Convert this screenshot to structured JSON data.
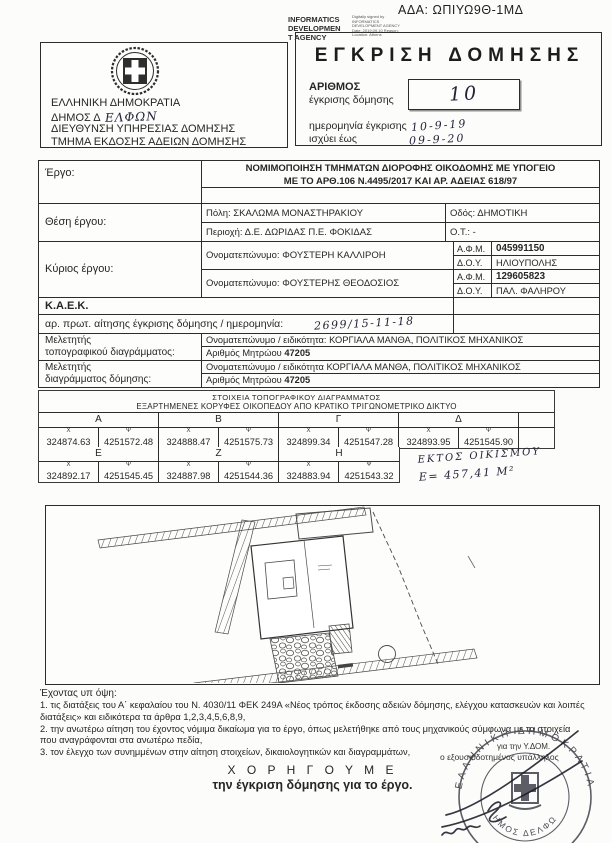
{
  "page": {
    "ada": "ΑΔΑ: ΩΠΙΥΩ9Θ-1ΜΔ",
    "title": "ΕΓΚΡΙΣΗ ΔΟΜΗΣΗΣ"
  },
  "digital_stamp": {
    "agency_line1": "INFORMATICS",
    "agency_line2": "DEVELOPMEN",
    "agency_line3": "T AGENCY",
    "detail_lines": "Digitally signed by INFORMATICS DEVELOPMENT AGENCY Date: 2019.09.10 Reason: Location: Athens"
  },
  "issuer": {
    "line1": "ΕΛΛΗΝΙΚΗ ΔΗΜΟΚΡΑΤΙΑ",
    "line2_printed": "ΔΗΜΟΣ Δ",
    "line2_hand": "ΕΛΦΩΝ",
    "line3": "ΔΙΕΥΘΥΝΣΗ ΥΠΗΡΕΣΙΑΣ ΔΟΜΗΣΗΣ",
    "line4": "ΤΜΗΜΑ ΕΚΔΟΣΗΣ ΑΔΕΙΩΝ ΔΟΜΗΣΗΣ"
  },
  "approval": {
    "number_label1": "ΑΡΙΘΜΟΣ",
    "number_label2": "έγκρισης δόμησης",
    "number_value": "10",
    "date_label": "ημερομηνία έγκρισης",
    "date_value": "10-9-19",
    "valid_label": "ισχύει έως",
    "valid_value": "09-9-20"
  },
  "project": {
    "label": "Έργο:",
    "line1": "ΝΟΜΙΜΟΠΟΙΗΣΗ ΤΜΗΜΑΤΩΝ ΔΙΟΡΟΦΗΣ ΟΙΚΟΔΟΜΗΣ ΜΕ ΥΠΟΓΕΙΟ",
    "line2": "ΜΕ ΤΟ ΑΡΘ.106 Ν.4495/2017 ΚΑΙ ΑΡ. ΑΔΕΙΑΣ 618/97"
  },
  "location": {
    "label": "Θέση έργου:",
    "city": "Πόλη: ΣΚΑΛΩΜΑ ΜΟΝΑΣΤΗΡΑΚΙΟΥ",
    "street": "Οδός: ΔΗΜΟΤΙΚΗ",
    "area": "Περιοχή: Δ.Ε. ΔΩΡΙΔΑΣ Π.Ε. ΦΟΚΙΔΑΣ",
    "ot": "Ο.Τ.: -"
  },
  "owner": {
    "label": "Κύριος  έργου:",
    "afm_label": "Α.Φ.Μ.",
    "doy_label": "Δ.Ο.Υ.",
    "entries": [
      {
        "name": "Ονοματεπώνυμο: ΦΟΥΣΤΕΡΗ ΚΑΛΛΙΡΟΗ",
        "afm": "045991150",
        "doy": "ΗΛΙΟΥΠΟΛΗΣ"
      },
      {
        "name": "Ονοματεπώνυμο: ΦΟΥΣΤΕΡΗΣ ΘΕΟΔΟΣΙΟΣ",
        "afm": "129605823",
        "doy": "ΠΑΛ. ΦΑΛΗΡΟΥ"
      }
    ]
  },
  "kaek": {
    "label": "Κ.Α.Ε.Κ."
  },
  "protocol": {
    "label": "αρ. πρωτ. αίτησης έγκρισης δόμησης / ημερομηνία:",
    "value": "2699/15-11-18"
  },
  "surveyor_topo": {
    "label_line1": "Μελετητής",
    "label_line2": "τοπογραφικού διαγράμματος:",
    "name_line": "Ονοματεπώνυμο / ειδικότητα: ΚΟΡΓΙΑΛΑ ΜΑΝΘΑ, ΠΟΛΙΤΙΚΟΣ ΜΗΧΑΝΙΚΟΣ",
    "reg_label": "Αριθμός Μητρώου",
    "reg_value": "47205"
  },
  "surveyor_diagram": {
    "label_line1": "Μελετητής",
    "label_line2": "διαγράμματος δόμησης:",
    "name_line": "Ονοματεπώνυμο / ειδικότητα ΚΟΡΓΙΑΛΑ ΜΑΝΘΑ, ΠΟΛΙΤΙΚΟΣ ΜΗΧΑΝΙΚΟΣ",
    "reg_label": "Αριθμός Μητρώου",
    "reg_value": "47205"
  },
  "coords": {
    "title1": "ΣΤΟΙΧΕΙΑ ΤΟΠΟΓΡΑΦΙΚΟΥ ΔΙΑΓΡΑΜΜΑΤΟΣ",
    "title2": "ΕΞΑΡΤΗΜΕΝΕΣ ΚΟΡΥΦΕΣ ΟΙΚΟΠΕΔΟΥ ΑΠΟ ΚΡΑΤΙΚΟ ΤΡΙΓΩΝΟΜΕΤΡΙΚΟ ΔΙΚΤΥΟ",
    "x_sym": "Χ",
    "y_sym": "Ψ",
    "points": [
      {
        "label": "Α",
        "x": "324874.63",
        "y": "4251572.48"
      },
      {
        "label": "Β",
        "x": "324888.47",
        "y": "4251575.73"
      },
      {
        "label": "Γ",
        "x": "324899.34",
        "y": "4251547.28"
      },
      {
        "label": "Δ",
        "x": "324893.95",
        "y": "4251545.90"
      },
      {
        "label": "Ε",
        "x": "324892.17",
        "y": "4251545.45"
      },
      {
        "label": "Ζ",
        "x": "324887.98",
        "y": "4251544.36"
      },
      {
        "label": "Η",
        "x": "324883.94",
        "y": "4251543.32"
      }
    ],
    "note_line1": "ΕΚΤΟΣ ΟΙΚΙΣΜΟΥ",
    "note_line2": "Ε= 457,41 Μ²"
  },
  "footer": {
    "intro": "Έχοντας υπ όψη:",
    "items": [
      "1. τις διατάξεις του Α΄ κεφαλαίου του Ν. 4030/11 ΦΕΚ 249Α «Νέος τρόπος έκδοσης αδειών δόμησης, ελέγχου κατασκευών και λοιπές διατάξεις» και ειδικότερα τα άρθρα 1,2,3,4,5,6,8,9,",
      "2. την ανωτέρω αίτηση του έχοντος νόμιμα δικαίωμα για το έργο, όπως μελετήθηκε από τους μηχανικούς σύμφωνα με τα στοιχεία που αναγράφονται στα ανωτέρω πεδία,",
      "3. τον έλεγχο των συνημμένων στην αίτηση στοιχείων, δικαιολογητικών και διαγραμμάτων,"
    ],
    "grant1": "Χ Ο Ρ Η Γ Ο Υ Μ Ε",
    "grant2": "την έγκριση δόμησης για το έργο."
  },
  "signature": {
    "for_line": "για την Υ.ΔΟΜ.",
    "officer": "ο εξουσιοδοτημένος υπάλληλος",
    "stamp_republic": "ΕΛΛΗΝΙΚΗ ΔΗΜΟΚΡΑΤΙΑ",
    "stamp_municipality": "ΔΗΜΟΣ ΔΕΛΦΩΝ",
    "stamp_star": "★"
  }
}
